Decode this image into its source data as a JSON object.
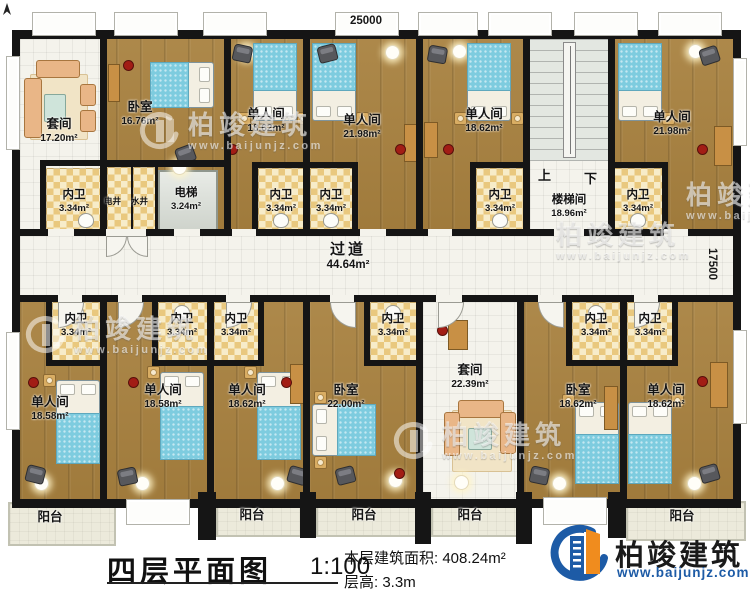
{
  "dims": {
    "top": "25000",
    "right": "17500"
  },
  "plan": {
    "balcony_label": "阳台",
    "corridor": {
      "name": "过道",
      "area": "44.64m²"
    },
    "stair": {
      "name": "楼梯间",
      "area": "18.96m²",
      "up": "上",
      "down": "下"
    },
    "elevator": {
      "name": "电梯",
      "area": "3.24m²"
    },
    "shafts": {
      "electric": "电井",
      "water": "水井"
    },
    "bath": {
      "name": "内卫",
      "area": "3.34m²"
    },
    "top_rooms": [
      {
        "name": "套间",
        "area": "17.20m²"
      },
      {
        "name": "卧室",
        "area": "16.76m²"
      },
      {
        "name": "单人间",
        "area": "18.62m²"
      },
      {
        "name": "单人间",
        "area": "21.98m²"
      },
      {
        "name": "单人间",
        "area": "18.62m²"
      },
      {
        "name": "单人间",
        "area": "21.98m²"
      }
    ],
    "bottom_rooms": [
      {
        "name": "单人间",
        "area": "18.58m²"
      },
      {
        "name": "单人间",
        "area": "18.58m²"
      },
      {
        "name": "单人间",
        "area": "18.62m²"
      },
      {
        "name": "卧室",
        "area": "22.00m²"
      },
      {
        "name": "套间",
        "area": "22.39m²"
      },
      {
        "name": "卧室",
        "area": "18.62m²"
      },
      {
        "name": "单人间",
        "area": "18.62m²"
      }
    ]
  },
  "titleblock": {
    "title": "四层平面图",
    "scale": "1:100",
    "area_label": "本层建筑面积:",
    "area_value": "408.24m²",
    "height_label": "层高:",
    "height_value": "3.3m"
  },
  "brand": {
    "name": "柏竣建筑",
    "url": "www.baijunjz.com"
  },
  "watermark": {
    "name": "柏竣建筑",
    "url": "www.baijunjz.com"
  },
  "colors": {
    "wall": "#151515",
    "wood": "#a8813f",
    "tile": "#f4f3ec",
    "checker": "#e9c87e",
    "bed": "#7eccdf",
    "brand_blue": "#1d5ba6",
    "brand_orange": "#f08c1e",
    "marker_red": "#a21d15"
  }
}
